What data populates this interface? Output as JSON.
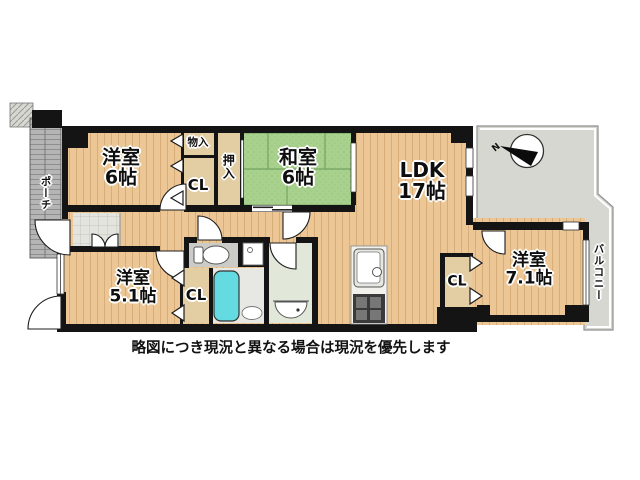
{
  "plan": {
    "rooms": {
      "west1": {
        "name": "洋室",
        "size": "6帖"
      },
      "washitsu": {
        "name": "和室",
        "size": "6帖"
      },
      "ldk": {
        "name": "LDK",
        "size": "17帖"
      },
      "west2": {
        "name": "洋室",
        "size": "5.1帖"
      },
      "west3": {
        "name": "洋室",
        "size": "7.1帖"
      }
    },
    "closets": {
      "monoire": "物入",
      "oshiire": "押入",
      "cl_north": "CL",
      "cl_south": "CL",
      "cl_east": "CL"
    },
    "outdoor": {
      "porch": "ポーチ",
      "balcony": "バルコニー"
    },
    "compass": {
      "north": "N"
    }
  },
  "caption": "略図につき現況と異なる場合は現況を優先します",
  "colors": {
    "wood": "#ecc795",
    "closet": "#e3cda3",
    "tatami": "#a9d18e",
    "tatami_line": "#75a362",
    "wall": "#141414",
    "balcony": "#d7d7d2",
    "porch": "#b5b5b5",
    "tile": "#e4e4de",
    "tub": "#63dbe0",
    "washroom": "#e1e8da",
    "bath": "#e7e7e3",
    "toilet_floor": "#cbcbc7"
  }
}
